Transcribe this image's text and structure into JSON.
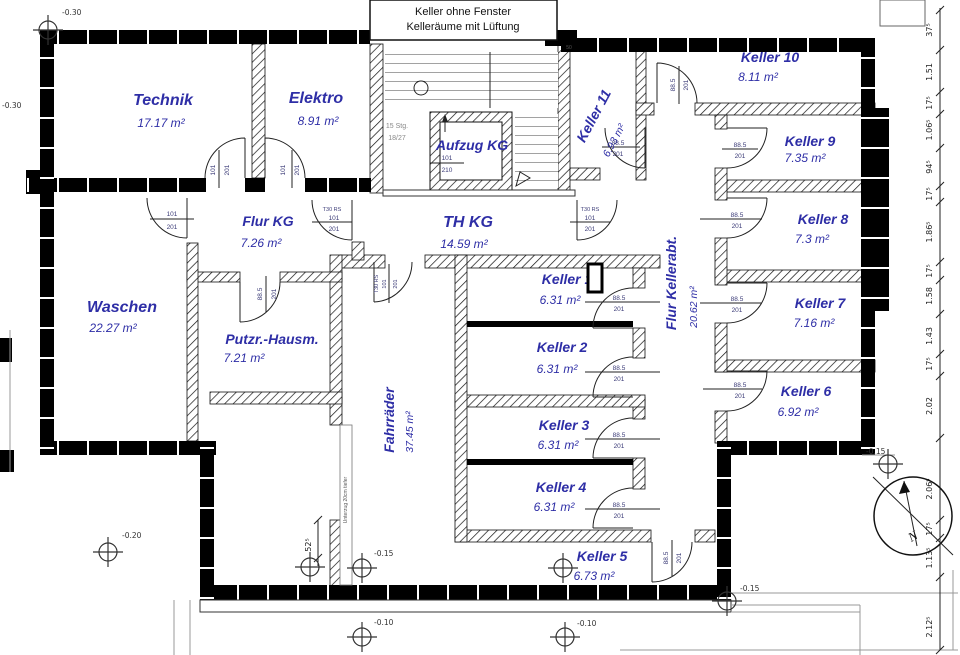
{
  "header": {
    "line1": "Keller ohne Fenster",
    "line2": "Kelleräume mit Lüftung"
  },
  "rooms": {
    "technik": {
      "name": "Technik",
      "area": "17.17 m²"
    },
    "elektro": {
      "name": "Elektro",
      "area": "8.91 m²"
    },
    "aufzug": {
      "name": "Aufzug KG"
    },
    "flur_kg": {
      "name": "Flur KG",
      "area": "7.26 m²"
    },
    "th_kg": {
      "name": "TH KG",
      "area": "14.59 m²"
    },
    "waschen": {
      "name": "Waschen",
      "area": "22.27 m²"
    },
    "putzr": {
      "name": "Putzr.-Hausm.",
      "area": "7.21 m²"
    },
    "fahrraeder": {
      "name": "Fahrräder",
      "area": "37.45 m²"
    },
    "flur_kellerabt": {
      "name": "Flur Kellerabt.",
      "area": "20.62 m²"
    },
    "keller1": {
      "name": "Keller 1",
      "area": "6.31 m²"
    },
    "keller2": {
      "name": "Keller 2",
      "area": "6.31 m²"
    },
    "keller3": {
      "name": "Keller 3",
      "area": "6.31 m²"
    },
    "keller4": {
      "name": "Keller 4",
      "area": "6.31 m²"
    },
    "keller5": {
      "name": "Keller 5",
      "area": "6.73 m²"
    },
    "keller6": {
      "name": "Keller 6",
      "area": "6.92 m²"
    },
    "keller7": {
      "name": "Keller 7",
      "area": "7.16 m²"
    },
    "keller8": {
      "name": "Keller 8",
      "area": "7.3 m²"
    },
    "keller9": {
      "name": "Keller 9",
      "area": "7.35 m²"
    },
    "keller10": {
      "name": "Keller 10",
      "area": "8.11 m²"
    },
    "keller11": {
      "name": "Keller 11",
      "area": "6.93 m²"
    }
  },
  "door_labels": {
    "w885": "88.5",
    "w101": "101",
    "h201": "201",
    "h210": "210",
    "t30": "T30 RS"
  },
  "stairs": {
    "l1": "15 Stg.",
    "l2": "18/27"
  },
  "levels": {
    "l030": "-0.30",
    "l020": "-0.20",
    "l015": "-0.15",
    "l010": "-0.10"
  },
  "dims": {
    "right": [
      "37⁵",
      "1.51",
      "17⁵",
      "1.06⁵",
      "94⁵",
      "17⁵",
      "1.86⁵",
      "17⁵",
      "1.58",
      "1.43",
      "17⁵",
      "2.02",
      "2.06⁵",
      "17⁵",
      "1.13⁵",
      "2.12⁵"
    ],
    "d52": "52⁵",
    "d50": "50"
  },
  "notes": {
    "unterzug": "Unterzug 20cm tiefer"
  },
  "compass": {
    "n": "N"
  }
}
